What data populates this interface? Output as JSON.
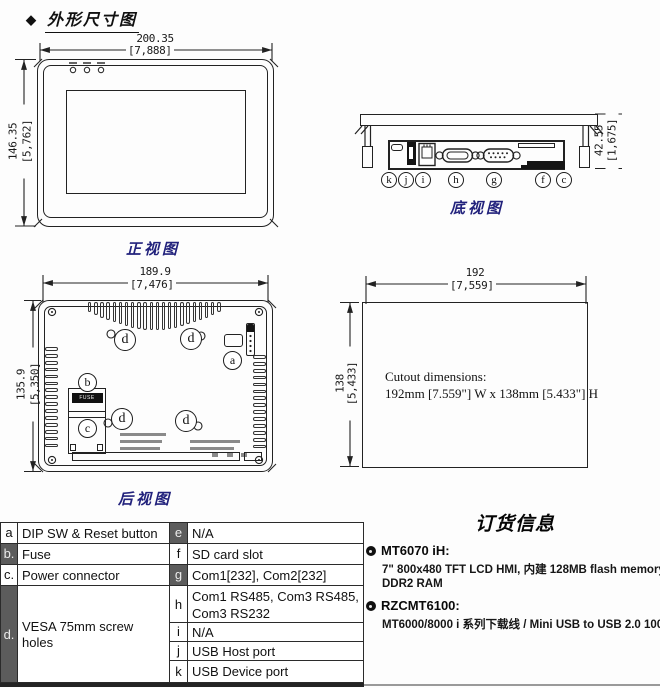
{
  "page": {
    "diamond": "◆",
    "title": "外形尺寸图"
  },
  "front_view": {
    "caption": "正视图",
    "width_mm": "200.35",
    "width_in": "[7,888]",
    "height_mm": "146.35",
    "height_in": "[5,762]"
  },
  "bottom_view": {
    "caption": "底视图",
    "height_mm": "42.55",
    "height_in": "[1,675]",
    "port_labels": [
      "k",
      "j",
      "i",
      "h",
      "g",
      "f",
      "c"
    ]
  },
  "rear_view": {
    "caption": "后视图",
    "width_mm": "189.9",
    "width_in": "[7,476]",
    "height_mm": "135.9",
    "height_in": "[5,350]",
    "label_a": "a",
    "label_b": "b",
    "label_c": "c",
    "label_d": "d",
    "fuse_text": "FUSE"
  },
  "cutout": {
    "width_mm": "192",
    "width_in": "[7,559]",
    "height_mm": "138",
    "height_in": "[5,433]",
    "note_line1": "Cutout dimensions:",
    "note_line2": "192mm [7.559\"] W x 138mm [5.433\"] H"
  },
  "parts_table": {
    "left_rows": [
      {
        "key": "a",
        "label": "DIP SW & Reset button"
      },
      {
        "key": "b.",
        "label": "Fuse"
      },
      {
        "key": "c.",
        "label": "Power connector"
      },
      {
        "key": "d.",
        "label": "VESA 75mm screw holes"
      }
    ],
    "right_rows": [
      {
        "key": "e",
        "label": "N/A"
      },
      {
        "key": "f",
        "label": "SD card slot"
      },
      {
        "key": "g",
        "label": "Com1[232], Com2[232]"
      },
      {
        "key": "h",
        "label": "Com1 RS485, Com3 RS485, Com3 RS232"
      },
      {
        "key": "i",
        "label": "N/A"
      },
      {
        "key": "j",
        "label": "USB Host port"
      },
      {
        "key": "k",
        "label": "USB Device port"
      }
    ]
  },
  "ordering": {
    "title": "订货信息",
    "items": [
      {
        "name": "MT6070 iH:",
        "line1": "7\" 800x480 TFT LCD HMI, 内建 128MB flash memory/64MB",
        "line2": "DDR2 RAM"
      },
      {
        "name": "RZCMT6100:",
        "line1": "MT6000/8000 i 系列下载线  / Mini USB to USB 2.0 100 cm"
      }
    ]
  }
}
